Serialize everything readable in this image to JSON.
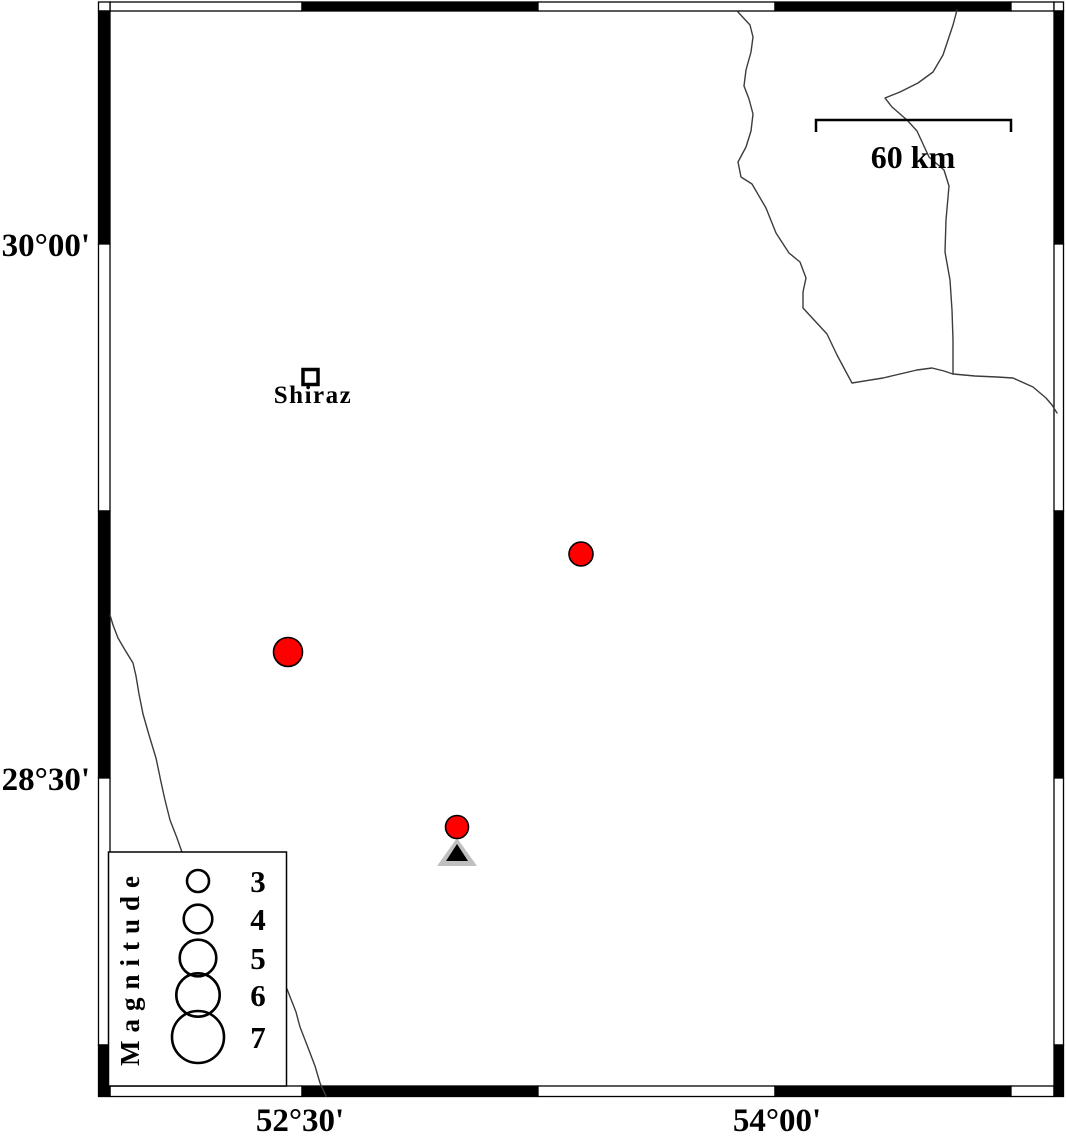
{
  "canvas": {
    "width": 1066,
    "height": 1136,
    "background": "#ffffff"
  },
  "colors": {
    "frame": "#000000",
    "river": "#3c3c3c",
    "earthquake_fill": "#ff0000",
    "marker_outline": "#000000",
    "station_gray": "#c0c0c0",
    "station_black": "#000000",
    "text": "#000000"
  },
  "frame": {
    "outer": {
      "x": 98.5,
      "y": 2,
      "x2": 1063.5,
      "y2": 1096.5
    },
    "inner": {
      "x": 110,
      "y": 11,
      "x2": 1054,
      "y2": 1086
    },
    "top_segments": [
      {
        "from": 110,
        "to": 302,
        "fill": "#ffffff"
      },
      {
        "from": 302,
        "to": 538,
        "fill": "#000000"
      },
      {
        "from": 538,
        "to": 775,
        "fill": "#ffffff"
      },
      {
        "from": 775,
        "to": 1011,
        "fill": "#000000"
      },
      {
        "from": 1011,
        "to": 1054,
        "fill": "#ffffff"
      }
    ],
    "bottom_segments": [
      {
        "from": 110,
        "to": 302,
        "fill": "#ffffff"
      },
      {
        "from": 302,
        "to": 538,
        "fill": "#000000"
      },
      {
        "from": 538,
        "to": 775,
        "fill": "#ffffff"
      },
      {
        "from": 775,
        "to": 1011,
        "fill": "#000000"
      },
      {
        "from": 1011,
        "to": 1054,
        "fill": "#ffffff"
      }
    ],
    "left_segments": [
      {
        "from": 11,
        "to": 244,
        "fill": "#000000"
      },
      {
        "from": 244,
        "to": 511,
        "fill": "#ffffff"
      },
      {
        "from": 511,
        "to": 778,
        "fill": "#000000"
      },
      {
        "from": 778,
        "to": 1045,
        "fill": "#ffffff"
      },
      {
        "from": 1045,
        "to": 1096.5,
        "fill": "#000000"
      }
    ],
    "right_segments": [
      {
        "from": 11,
        "to": 244,
        "fill": "#000000"
      },
      {
        "from": 244,
        "to": 511,
        "fill": "#ffffff"
      },
      {
        "from": 511,
        "to": 778,
        "fill": "#000000"
      },
      {
        "from": 778,
        "to": 1045,
        "fill": "#ffffff"
      },
      {
        "from": 1045,
        "to": 1096.5,
        "fill": "#000000"
      }
    ]
  },
  "axis_labels": {
    "left": [
      {
        "label": "30°00'",
        "x": 90,
        "y": 256
      },
      {
        "label": "28°30'",
        "x": 90,
        "y": 790
      }
    ],
    "bottom": [
      {
        "label": "52°30'",
        "x": 300,
        "y": 1131
      },
      {
        "label": "54°00'",
        "x": 777,
        "y": 1131
      }
    ]
  },
  "scale_bar": {
    "label": "60 km",
    "x1": 816,
    "x2": 1011,
    "bar_y": 120,
    "tick_drop": 12,
    "label_anchor": {
      "x": 913,
      "y": 168
    }
  },
  "city": {
    "name": "Shiraz",
    "marker": {
      "x": 310.5,
      "y": 377,
      "size": 15,
      "stroke_width": 3.5
    },
    "label_anchor": {
      "x": 313,
      "y": 403
    }
  },
  "earthquakes": [
    {
      "x": 581,
      "y": 554,
      "r": 12
    },
    {
      "x": 288,
      "y": 652,
      "r": 14.5
    },
    {
      "x": 457,
      "y": 827,
      "r": 11.5
    }
  ],
  "station": {
    "outer_triangle": [
      [
        437,
        866
      ],
      [
        477,
        866
      ],
      [
        457,
        838
      ]
    ],
    "inner_triangle": [
      [
        446,
        861
      ],
      [
        468,
        861
      ],
      [
        457,
        844
      ]
    ]
  },
  "rivers": [
    [
      [
        738,
        12
      ],
      [
        750,
        25
      ],
      [
        753,
        37
      ],
      [
        751,
        52
      ],
      [
        746,
        70
      ],
      [
        744,
        86
      ],
      [
        749,
        99
      ],
      [
        753,
        114
      ],
      [
        751,
        131
      ],
      [
        746,
        147
      ],
      [
        738,
        162
      ],
      [
        741,
        177
      ],
      [
        752,
        184
      ],
      [
        766,
        208
      ],
      [
        776,
        233
      ],
      [
        789,
        253
      ],
      [
        800,
        262
      ],
      [
        806,
        278
      ],
      [
        803,
        292
      ],
      [
        803,
        308
      ],
      [
        815,
        321
      ],
      [
        827,
        334
      ],
      [
        837,
        355
      ],
      [
        845,
        370
      ],
      [
        852,
        383
      ],
      [
        883,
        378
      ],
      [
        917,
        370
      ],
      [
        932,
        368
      ],
      [
        944,
        371
      ],
      [
        953,
        374
      ]
    ],
    [
      [
        957,
        10
      ],
      [
        953,
        25
      ],
      [
        948,
        40
      ],
      [
        943,
        55
      ],
      [
        933,
        72
      ],
      [
        918,
        83
      ],
      [
        900,
        92
      ],
      [
        885,
        98
      ],
      [
        892,
        107
      ],
      [
        907,
        120
      ],
      [
        917,
        131
      ],
      [
        929,
        157
      ],
      [
        944,
        170
      ],
      [
        949,
        186
      ],
      [
        946,
        220
      ],
      [
        945,
        252
      ],
      [
        950,
        280
      ],
      [
        952,
        310
      ],
      [
        953,
        340
      ],
      [
        953,
        374
      ]
    ],
    [
      [
        953,
        374
      ],
      [
        975,
        376
      ],
      [
        997,
        377
      ],
      [
        1013,
        378
      ],
      [
        1033,
        387
      ],
      [
        1046,
        398
      ],
      [
        1052,
        405
      ],
      [
        1057,
        413
      ]
    ],
    [
      [
        110,
        615
      ],
      [
        113,
        625
      ],
      [
        118,
        638
      ],
      [
        125,
        650
      ],
      [
        133,
        663
      ],
      [
        136,
        676
      ],
      [
        139,
        694
      ],
      [
        143,
        714
      ],
      [
        149,
        735
      ],
      [
        156,
        758
      ],
      [
        161,
        782
      ],
      [
        165,
        800
      ],
      [
        170,
        820
      ],
      [
        177,
        838
      ],
      [
        183,
        855
      ],
      [
        200,
        880
      ],
      [
        230,
        915
      ],
      [
        260,
        955
      ],
      [
        287,
        989
      ],
      [
        296,
        1012
      ],
      [
        300,
        1027
      ],
      [
        307,
        1045
      ],
      [
        315,
        1066
      ],
      [
        320,
        1083
      ],
      [
        326,
        1096
      ]
    ]
  ],
  "legend": {
    "title": "Magnitude",
    "box": {
      "x": 108.5,
      "y": 852,
      "w": 178,
      "h": 234
    },
    "title_anchor": {
      "x": 139,
      "y": 967
    },
    "circle_x": 198,
    "entries": [
      {
        "label": "3",
        "r": 11,
        "cy": 881,
        "label_anchor": {
          "x": 258,
          "y": 892
        }
      },
      {
        "label": "4",
        "r": 14.3,
        "cy": 919,
        "label_anchor": {
          "x": 258,
          "y": 930
        }
      },
      {
        "label": "5",
        "r": 18.3,
        "cy": 958,
        "label_anchor": {
          "x": 258,
          "y": 969
        }
      },
      {
        "label": "6",
        "r": 21.7,
        "cy": 995,
        "label_anchor": {
          "x": 258,
          "y": 1006
        }
      },
      {
        "label": "7",
        "r": 26,
        "cy": 1037,
        "label_anchor": {
          "x": 258,
          "y": 1048
        }
      }
    ]
  }
}
